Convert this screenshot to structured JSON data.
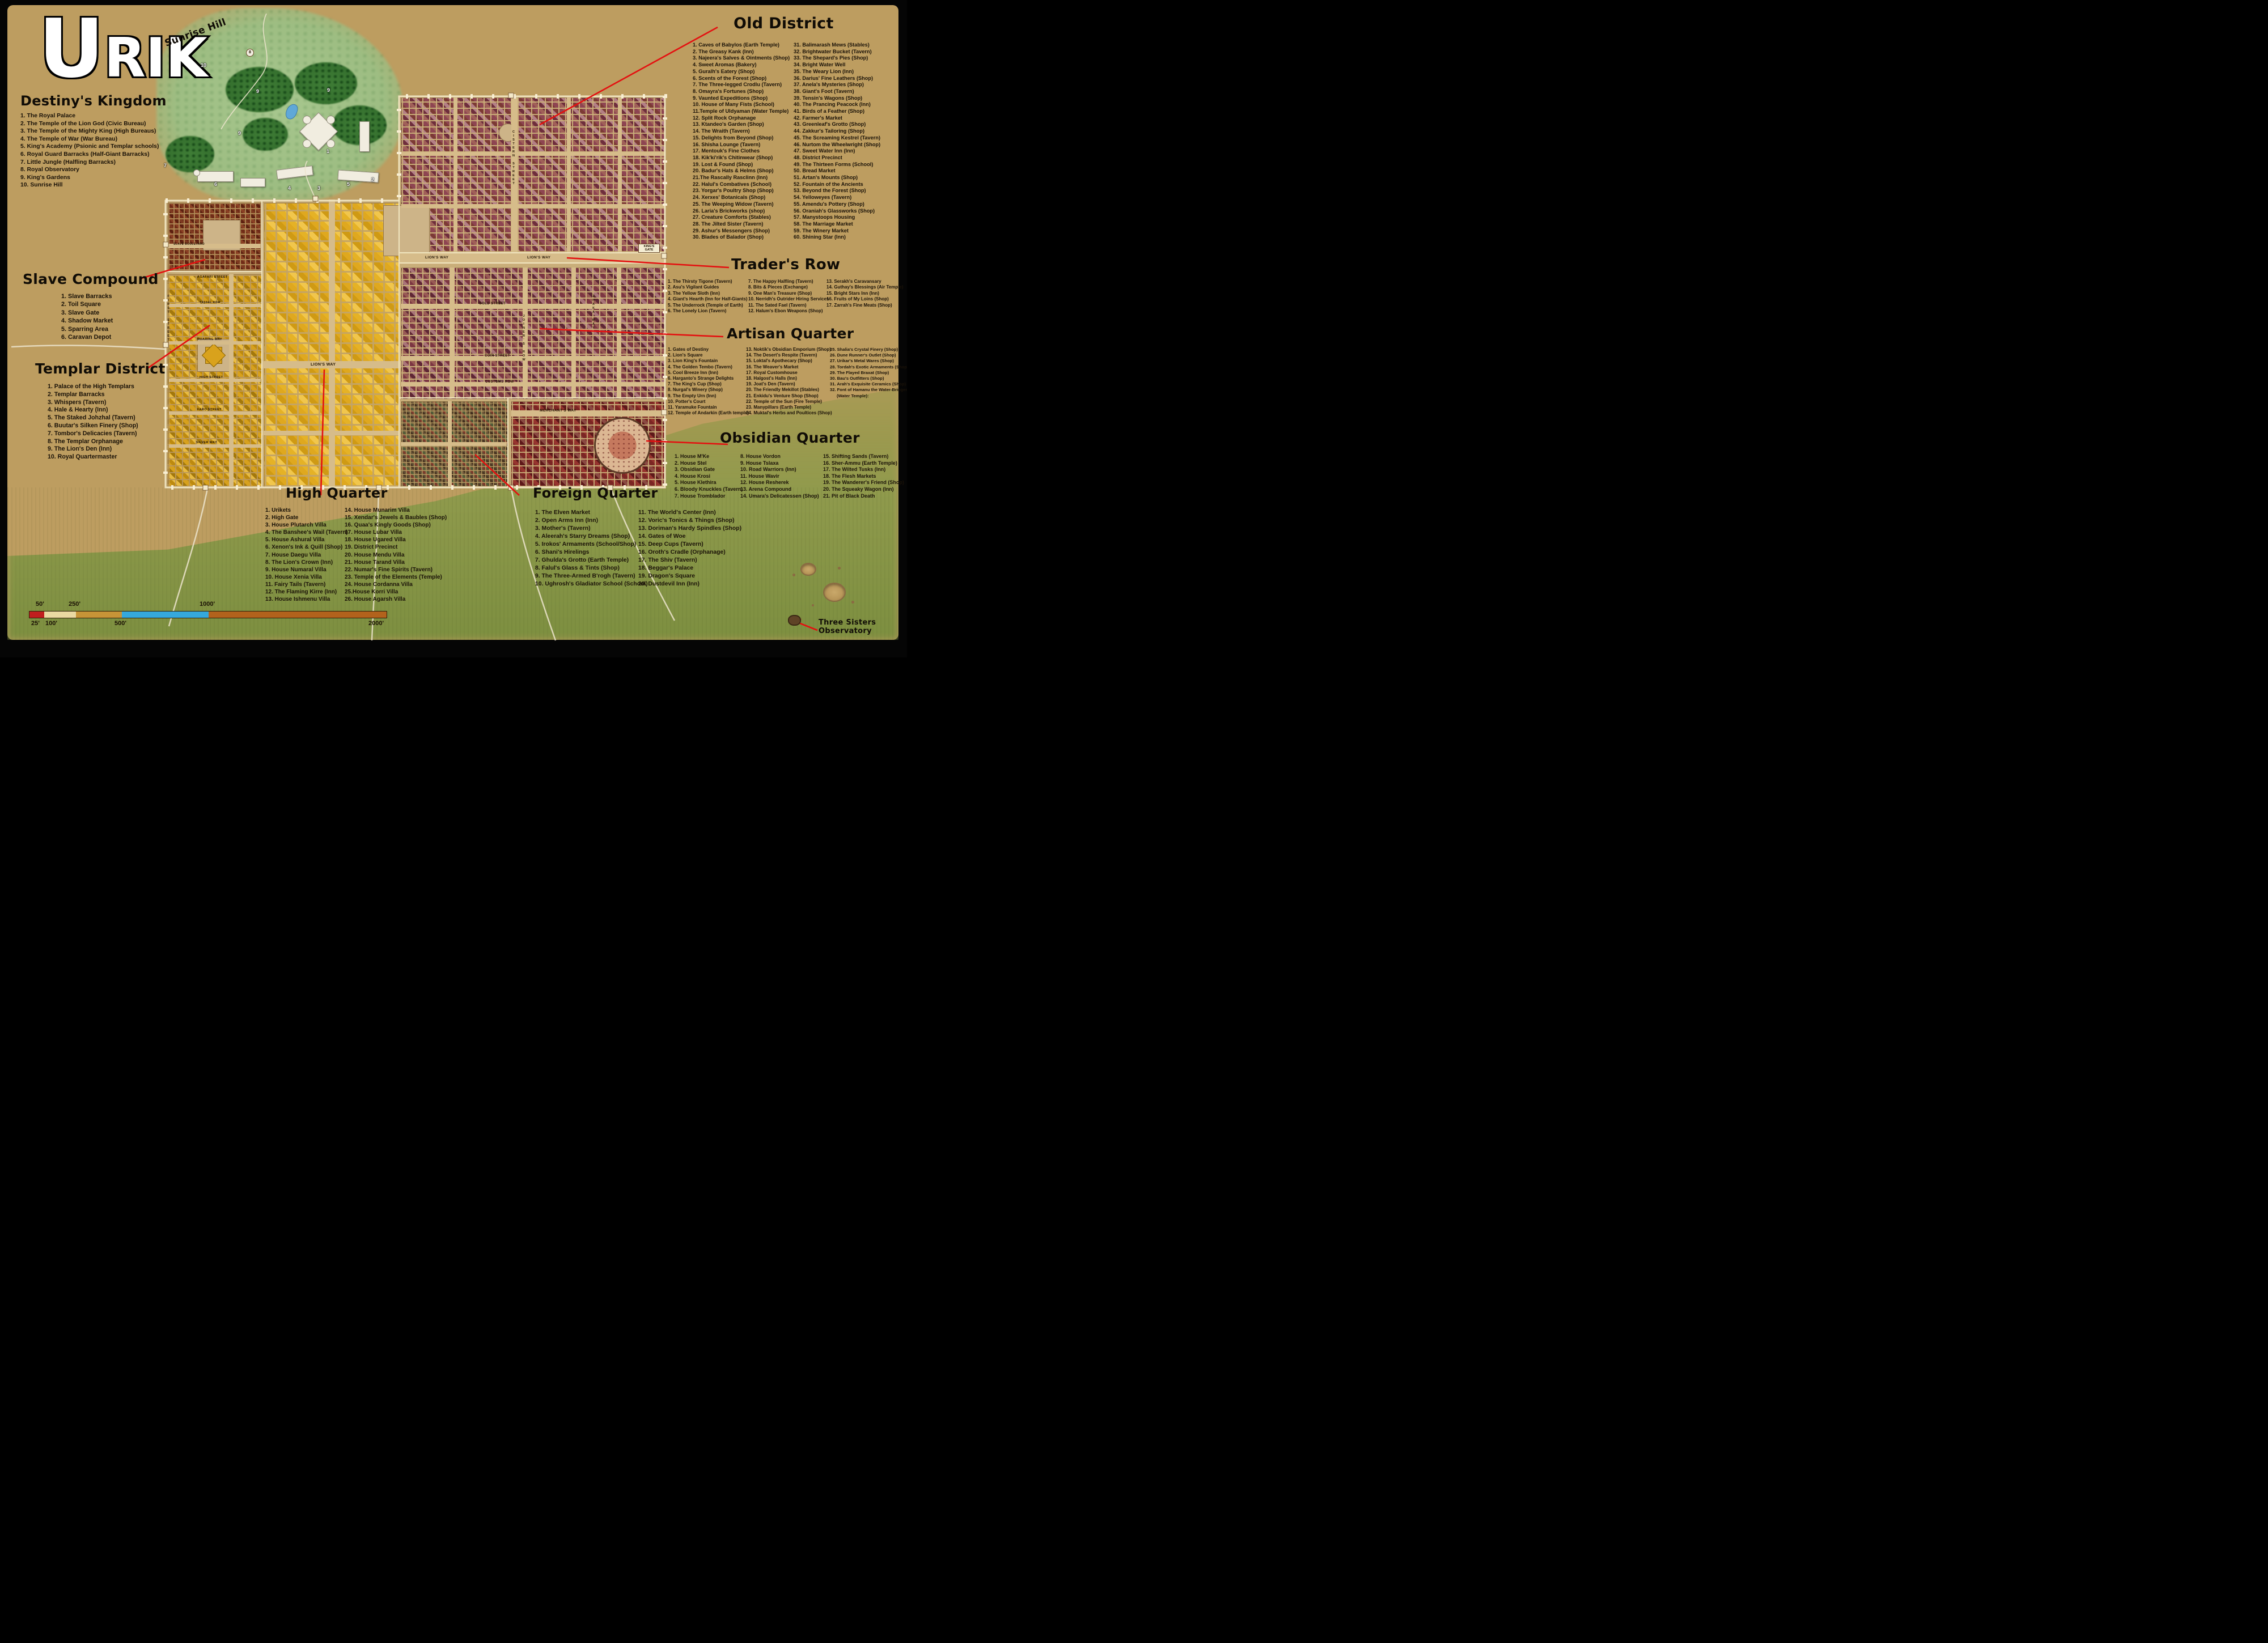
{
  "title": "URIK",
  "map_labels": {
    "sunrise_hill": "Sunrise Hill",
    "three_sisters": "Three Sisters Observatory",
    "kings_gate": "KING'S GATE"
  },
  "streets": {
    "lions_way": "LION'S WAY",
    "gold_street": "GOLD STREET",
    "joiners_row": "JOINER'S ROW",
    "coin_street": "COIN STREET",
    "customs_row": "CUSTOMS ROW",
    "merchants_way": "MERCHANT'S WAY",
    "cistern_street": "CISTERN STREET",
    "slave_boulevard": "SLAVE BOULEVARD",
    "agafari_street": "AGAFARI STREET",
    "tassel_row": "TASSEL ROW",
    "roaring_way": "ROARING WAY",
    "high_street": "HIGH STREET",
    "faro_street": "FARO STREET",
    "silver_way": "SILVER WAY",
    "first_street": "FIRST STREET",
    "zhaka_way": "ZHAKA WAY"
  },
  "royal_markers": [
    "1",
    "2",
    "3",
    "4",
    "5",
    "6",
    "7",
    "8",
    "9",
    "10"
  ],
  "scale_bar": {
    "top_labels": [
      "50'",
      "250'",
      "1000'"
    ],
    "bottom_labels": [
      "25'",
      "100'",
      "500'",
      "2000'"
    ],
    "segment_colors": [
      "#c01e1e",
      "#ead9a2",
      "#c79437",
      "#35a8dc",
      "#b2621c"
    ]
  },
  "accent_colors": {
    "callout_red": "#e41010",
    "wall_cream": "#efe3bd",
    "templar_gold": "#d7a11d",
    "old_district_maroon": "#8e4552"
  },
  "legends": {
    "destinys_kingdom": {
      "title": "Destiny's Kingdom",
      "columns": [
        [
          "1.   The Royal Palace",
          "2.   The Temple of the Lion God (Civic Bureau)",
          "3.   The Temple of the Mighty King (High Bureaus)",
          "4.   The Temple of War (War Bureau)",
          "5.   King's Academy (Psionic and Templar schools)",
          "6.   Royal Guard Barracks (Half-Giant Barracks)",
          "7.   Little Jungle (Halfling Barracks)",
          "8.   Royal Observatory",
          "9.   King's Gardens",
          "10.  Sunrise Hill"
        ]
      ]
    },
    "old_district": {
      "title": "Old District",
      "columns": [
        [
          "1. Caves of Babylos (Earth Temple)",
          "2. The Greasy Kank (Inn)",
          "3. Najeera's Salves & Ointments (Shop)",
          "4. Sweet Aromas (Bakery)",
          "5. Guralh's Eatery (Shop)",
          "6. Scents of the Forest (Shop)",
          "7. The Three-legged Crodlu (Tavern)",
          "8. Omayra's Fortunes (Shop)",
          "9. Vaunted Expeditions (Shop)",
          "10. House of Many Fists (School)",
          "11.Temple of Uldyaman (Water Temple)",
          "12. Split Rock Orphanage",
          "13. Ktandeo's Garden (Shop)",
          "14. The Wraith (Tavern)",
          "15. Delights from Beyond (Shop)",
          "16. Shisha Lounge (Tavern)",
          "17. Mentouk's Fine Clothes",
          "18. Kik'ki'rik's Chitinwear (Shop)",
          "19. Lost & Found (Shop)",
          "20. Badur's Hats & Helms (Shop)",
          "21.The Rascally Rasclinn (Inn)",
          "22. Halul's Combatives (School)",
          "23. Yorgar's Poultry Shop (Shop)",
          "24. Xerxes' Botanicals (Shop)",
          "25. The Weeping Widow (Tavern)",
          "26.  Laria's Brickworks (shop)",
          "27. Creature Comforts (Stables)",
          "28. The Jilted Sister (Tavern)",
          "29.  Ashur's Messengers (Shop)",
          "30. Blades of Balador (Shop)"
        ],
        [
          "31. Balimarash Mews (Stables)",
          "32.  Brightwater Bucket (Tavern)",
          "33.  The Shepard's Pies (Shop)",
          "34.  Bright Water Well",
          "35. The Weary Lion (Inn)",
          "36.  Darius' Fine Leathers (Shop)",
          "37.  Anela's Mysteries (Shop)",
          "38.  Giant's Foot (Tavern)",
          "39.  Tensin's Wagons (Shop)",
          "40.  The Prancing Peacock (Inn)",
          "41.  Birds of a Feather (Shop)",
          "42.  Farmer's Market",
          "43.  Greenleaf's Grotto (Shop)",
          "44.  Zakkur's Tailoring (Shop)",
          "45.  The Screaming Kestrel (Tavern)",
          "46.   Nurtom the Wheelwright (Shop)",
          "47.  Sweet Water Inn (Inn)",
          "48.  District Precinct",
          "49.  The Thirteen Forms (School)",
          "50.  Bread Market",
          "51.  Artan's Mounts (Shop)",
          "52.  Fountain of the Ancients",
          "53.  Beyond the Forest (Shop)",
          "54.  Yelloweyes (Tavern)",
          "55.  Amendu's Pottery (Shop)",
          "56.  Oraniah's Glassworks (Shop)",
          "57.  Manystoops Housing",
          "58.  The Marriage Market",
          "59.  The Winery Market",
          "60.  Shining Star (Inn)"
        ]
      ]
    },
    "traders_row": {
      "title": "Trader's Row",
      "columns": [
        [
          "1. The Thirsty Tigone (Tavern)",
          "2. Asu's Vigilant Guides",
          "3. The Yellow Sloth (Inn)",
          "4. Giant's Hearth (Inn for Half-Giants)",
          "5. The Underrock (Temple of Earth)",
          "6. The Lonely Lion (Tavern)"
        ],
        [
          "7.   The Happy Halfling (Tavern)",
          "8.   Bits & Pieces (Exchange)",
          "9.   One Man's Treasure (Shop)",
          "10.  Nerridh's Outrider Hiring Services",
          "11.  The Sated Fael (Tavern)",
          "12.  Halum's Ebon Weapons (Shop)"
        ],
        [
          "13.  Serakh's Caravansary",
          "14.  Guthay's Blessings (Air Temple)",
          "15.  Bright Stars Inn (Inn)",
          "16.  Fruits of My Loins (Shop)",
          "17.  Zarrah's Fine Meats (Shop)"
        ]
      ]
    },
    "artisan_quarter": {
      "title": "Artisan Quarter",
      "columns": [
        [
          "1. Gates of Destiny",
          "2. Lion's Square",
          "3. Lion King's Fountain",
          "4. The Golden Tembo (Tavern)",
          "5. Cool Breeze Inn (Inn)",
          "6. Harganto's Strange Delights",
          "7. The King's Cup (Shop)",
          "8. Nurgal's Winery (Shop)",
          "9. The Empty Urn (Inn)",
          "10. Potter's Court",
          "11. Yaramuke Fountain",
          "12. Temple of Andarkin (Earth temple)"
        ],
        [
          "13. Noktik's Obsidian Emporium (Shop)",
          "14. The Desert's Respite (Tavern)",
          "15. Loktal's Apothecary (Shop)",
          "16. The Weaver's Market",
          "17. Royal Customhouse",
          "18. Halgost's Halls (Inn)",
          "19. Joat's Den (Tavern)",
          "20. The Friendly Mekillot (Stables)",
          "21. Enkidu's Venture Shop (Shop)",
          "22. Temple of the Sun (Fire Temple)",
          "23. Manypillars (Earth Temple)",
          "24. Muktal's Herbs and Poultices (Shop)"
        ],
        [
          "25.  Shalia's Crystal Finery (Shop)",
          "26.  Dune Runner's Outlet (Shop)",
          "27.  Urikar's Metal Wares (Shop)",
          "28.  Tordah's Exotic Armaments (Shop)",
          "29.  The Flayed Braxat (Shop)",
          "30.   Bau's Outfitters (Shop)",
          "31.  Arah's Exquisite Ceramics (Shop)",
          "32.  Font of Hamanu the Water-Bringer (Water Temple):"
        ]
      ]
    },
    "obsidian_quarter": {
      "title": "Obsidian Quarter",
      "columns": [
        [
          "1. House M'Ke",
          "2. House Stel",
          "3. Obsidian Gate",
          "4. House Krosi",
          "5. House Klethira",
          "6. Bloody Knuckles (Tavern)",
          "7. House Tromblador"
        ],
        [
          "8.   House Vordon",
          "9.   House Tslaxa",
          "10.  Road Warriors (Inn)",
          "11.  House Wavir",
          "12.  House Resherek",
          "13.  Arena Compound",
          "14.  Umara's Delicatessen (Shop)"
        ],
        [
          "15.  Shifting Sands  (Tavern)",
          "16.  Sher-Ammu (Earth Temple)",
          "17.  The Wilted Tusks (Inn)",
          "18.  The Flesh Markets",
          "19.  The Wanderer's Friend (Shop)",
          "20.  The Squeaky Wagon (Inn)",
          "21.  Pit of Black Death"
        ]
      ]
    },
    "slave_compound": {
      "title": "Slave Compound",
      "columns": [
        [
          "1. Slave Barracks",
          "2. Toil Square",
          "3. Slave Gate",
          "4. Shadow Market",
          "5. Sparring Area",
          "6. Caravan Depot"
        ]
      ]
    },
    "templar_district": {
      "title": "Templar District",
      "columns": [
        [
          "1. Palace of the High Templars",
          "2. Templar Barracks",
          "3. Whispers (Tavern)",
          "4. Hale & Hearty (Inn)",
          "5. The Staked Johzhal (Tavern)",
          "6. Buutar's Silken Finery (Shop)",
          "7. Tombor's Delicacies (Tavern)",
          "8. The Templar Orphanage",
          "9. The Lion's Den (Inn)",
          "10. Royal Quartermaster"
        ]
      ]
    },
    "high_quarter": {
      "title": "High Quarter",
      "columns": [
        [
          "1. Urikets",
          "2. High Gate",
          "3. House Plutarch Villa",
          "4. The Banshee's Wail (Tavern)",
          "5. House Ashural Villa",
          "6. Xenon's Ink & Quill (Shop)",
          "7. House Daegu Villa",
          "8. The Lion's Crown (Inn)",
          "9. House Numaral Villa",
          "10. House Xenia Villa",
          "11. Fairy Tails (Tavern)",
          "12. The Flaming Kirre (Inn)",
          "13. House Ishmenu Villa"
        ],
        [
          "14. House Munarim Villa",
          "15. Xendar's Jewels & Baubles (Shop)",
          "16. Quaa's Kingly Goods (Shop)",
          "17. House Lubar Villa",
          "18. House Ugared Villa",
          "19. District Precinct",
          "20. House Mendu Villa",
          "21. House Tarand  Villa",
          "22. Numar's Fine Spirits (Tavern)",
          "23. Temple of the Elements (Temple)",
          "24. House Cordanna Villa",
          "25.House Korri Villa",
          "26. House Agarsh Villa"
        ]
      ]
    },
    "foreign_quarter": {
      "title": "Foreign Quarter",
      "columns": [
        [
          "1. The Elven Market",
          "2. Open Arms Inn (Inn)",
          "3. Mother's (Tavern)",
          "4. Aleerah's Starry Dreams (Shop)",
          "5. Irokos' Armaments (School/Shop)",
          "6. Shani's Hirelings",
          "7. Ghulda's Grotto (Earth Temple)",
          "8. Falul's Glass & Tints (Shop)",
          "9. The Three-Armed B'rogh (Tavern)",
          "10. Ughrosh's Gladiator School (School)"
        ],
        [
          "11. The World's Center (Inn)",
          "12. Voric's Tonics & Things (Shop)",
          "13. Doriman's Hardy Spindles (Shop)",
          "14. Gates of Woe",
          "15. Deep Cups (Tavern)",
          "16. Oroth's Cradle (Orphanage)",
          "17. The Shiv (Tavern)",
          "18. Beggar's Palace",
          "19. Dragon's Square",
          "20. Dustdevil Inn (Inn)"
        ]
      ]
    }
  }
}
